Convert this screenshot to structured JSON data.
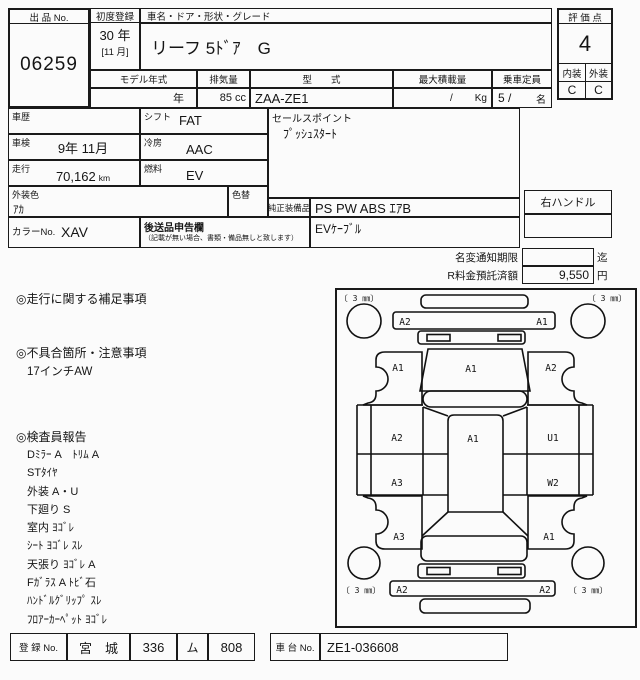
{
  "header": {
    "lot_label": "出 品 No.",
    "lot_no": "06259",
    "first_reg_label": "初度登録",
    "first_reg_year": "30 年",
    "first_reg_month": "[11 月]",
    "car_name_label": "車名・ドア・形状・グレード",
    "car_name": "リーフ 5ﾄﾞｱ　G",
    "model_year_label": "モデル年式",
    "model_year_value": "年",
    "displacement_label": "排気量",
    "displacement_value": "85 cc",
    "model_code_label": "型　　式",
    "model_code": "ZAA-ZE1",
    "max_load_label": "最大積載量",
    "max_load_slash": "/",
    "max_load_unit": "Kg",
    "capacity_label": "乗車定員",
    "capacity_value": "5 /",
    "capacity_unit": "名",
    "score_label": "評 価 点",
    "score": "4",
    "interior_label": "内装",
    "exterior_label": "外装",
    "interior_grade": "C",
    "exterior_grade": "C"
  },
  "details": {
    "history_label": "車歴",
    "history": "",
    "inspection_label": "車検",
    "inspection": "9年 11月",
    "mileage_label": "走行",
    "mileage": "70,162",
    "mileage_unit": "km",
    "shift_label": "シフト",
    "shift": "FAT",
    "ac_label": "冷房",
    "ac": "AAC",
    "fuel_label": "燃料",
    "fuel": "EV",
    "ext_color_label": "外装色",
    "ext_color": "ｱｶ",
    "color_change_label": "色替",
    "color_no_label": "カラーNo.",
    "color_no": "XAV",
    "later_items_label": "後送品申告欄",
    "later_items_note": "（記載が無い場合、書類・備品無しと致します）",
    "sales_point_label": "セールスポイント",
    "sales_point": "ﾌﾟｯｼｭｽﾀｰﾄ",
    "equipment_label": "純正装備品",
    "equipment": "PS PW ABS ｴｱB",
    "equipment2": "EVｹｰﾌﾞﾙ",
    "handle": "右ハンドル"
  },
  "notice": {
    "name_change_label": "名変通知期限",
    "name_change_value": "",
    "name_change_suffix": "迄",
    "recycle_label": "R料金預託済額",
    "recycle_value": "9,550",
    "recycle_suffix": "円"
  },
  "notes": {
    "mileage_notes_title": "◎走行に関する補足事項",
    "defects_title": "◎不具合箇所・注意事項",
    "defect_1": "17インチAW",
    "inspector_title": "◎検査員報告",
    "inspector_lines": [
      "Dﾐﾗｰ A　ﾄﾘﾑ A",
      "STﾀｲﾔ",
      "外装 A・U",
      "下廻り S",
      "室内 ﾖｺﾞﾚ",
      "ｼｰﾄ ﾖｺﾞﾚ ｽﾚ",
      "天張り ﾖｺﾞﾚ A",
      "Fｶﾞﾗｽ A ﾄﾋﾞ石",
      "ﾊﾝﾄﾞﾙｸﾞﾘｯﾌﾟ ｽﾚ",
      "ﾌﾛｱｰｶｰﾍﾟｯﾄ ﾖｺﾞﾚ"
    ]
  },
  "diagram": {
    "tire_fl": "〔 3 ㎜〕",
    "tire_fr": "〔 3 ㎜〕",
    "tire_rl": "〔 3 ㎜〕",
    "tire_rr": "〔 3 ㎜〕",
    "front_bumper_left": "A2",
    "front_bumper_right": "A1",
    "fender_front_left": "A1",
    "hood": "A1",
    "fender_front_right": "A2",
    "door_left_front": "A2",
    "door_left_rear": "A3",
    "roof": "A1",
    "door_right_front": "U1",
    "door_right_rear": "W2",
    "fender_rear_left": "A3",
    "fender_rear_right": "A1",
    "rear_bumper_left": "A2",
    "rear_bumper_right": "A2"
  },
  "footer": {
    "reg_label": "登 録 No.",
    "reg_area": "宮　城",
    "reg_class": "336",
    "reg_kana": "ム",
    "reg_number": "808",
    "chassis_label": "車 台 No.",
    "chassis_no": "ZE1-036608"
  }
}
